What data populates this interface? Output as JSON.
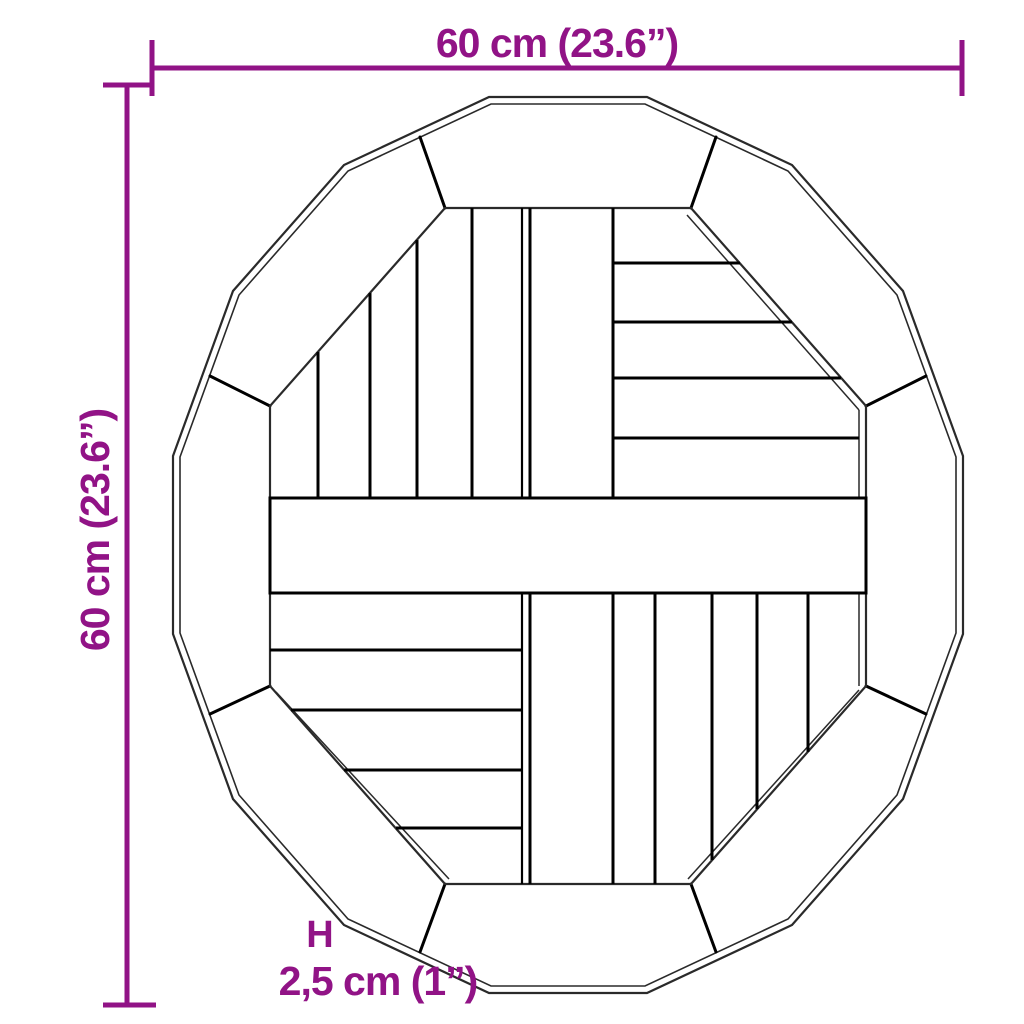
{
  "colors": {
    "dimension": "#911386",
    "outline": "#2a2a2a",
    "plank_line": "#000000",
    "background": "#ffffff"
  },
  "dimensions": {
    "width": {
      "label": "60 cm (23.6”)"
    },
    "height": {
      "label": "60 cm (23.6”)"
    },
    "thickness": {
      "marker": "H",
      "label": "2,5 cm (1”)"
    }
  }
}
